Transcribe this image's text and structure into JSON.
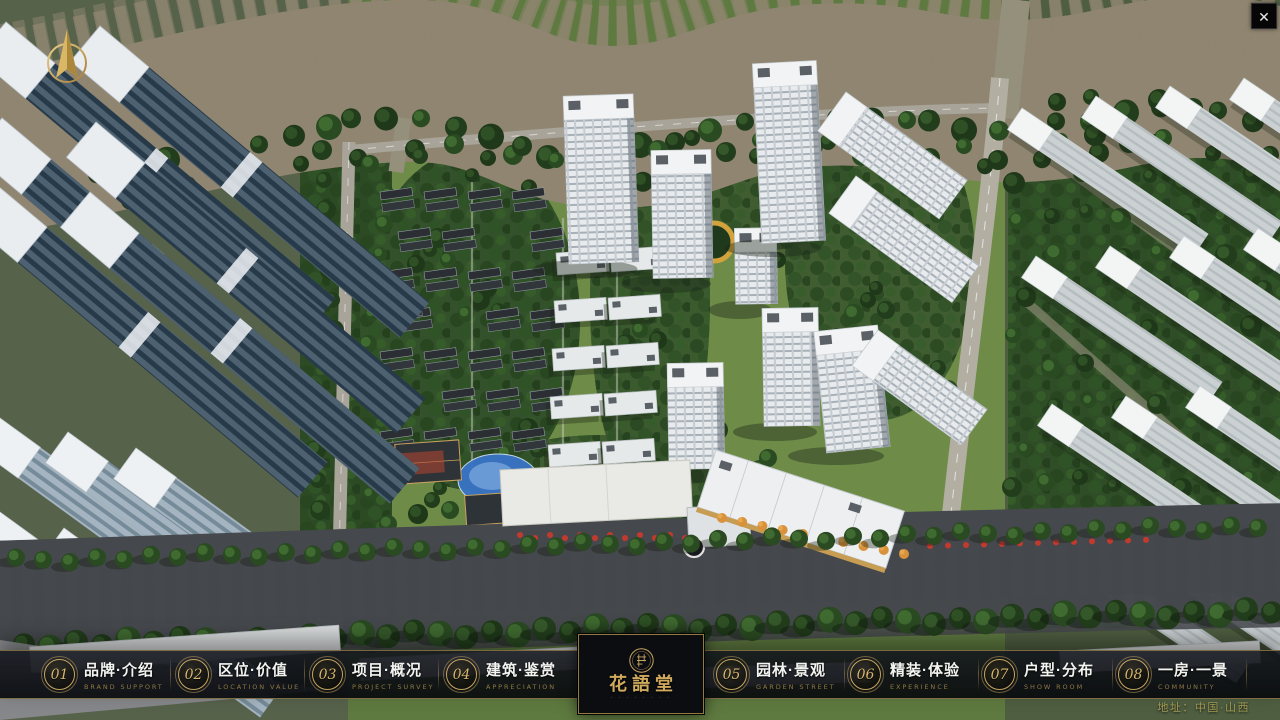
{
  "window": {
    "close_label": "✕"
  },
  "nav": {
    "items": [
      {
        "num": "01",
        "label": "品牌·介绍",
        "sub": "BRAND SUPPORT"
      },
      {
        "num": "02",
        "label": "区位·价值",
        "sub": "LOCATION VALUE"
      },
      {
        "num": "03",
        "label": "项目·概况",
        "sub": "PROJECT SURVEY"
      },
      {
        "num": "04",
        "label": "建筑·鉴赏",
        "sub": "APPRECIATION"
      },
      {
        "num": "05",
        "label": "园林·景观",
        "sub": "GARDEN STREET"
      },
      {
        "num": "06",
        "label": "精装·体验",
        "sub": "EXPERIENCE"
      },
      {
        "num": "07",
        "label": "户型·分布",
        "sub": "SHOW ROOM"
      },
      {
        "num": "08",
        "label": "一房·一景",
        "sub": "COMMUNITY"
      }
    ]
  },
  "logo": {
    "title": "花語堂",
    "subtitle": "· · · · · · · ·"
  },
  "footer": {
    "address": "地址：中国·山西"
  },
  "colors": {
    "gold": "#c8a55e",
    "river": "#2d62b0",
    "bar_bg": "rgba(10,13,18,0.9)"
  }
}
